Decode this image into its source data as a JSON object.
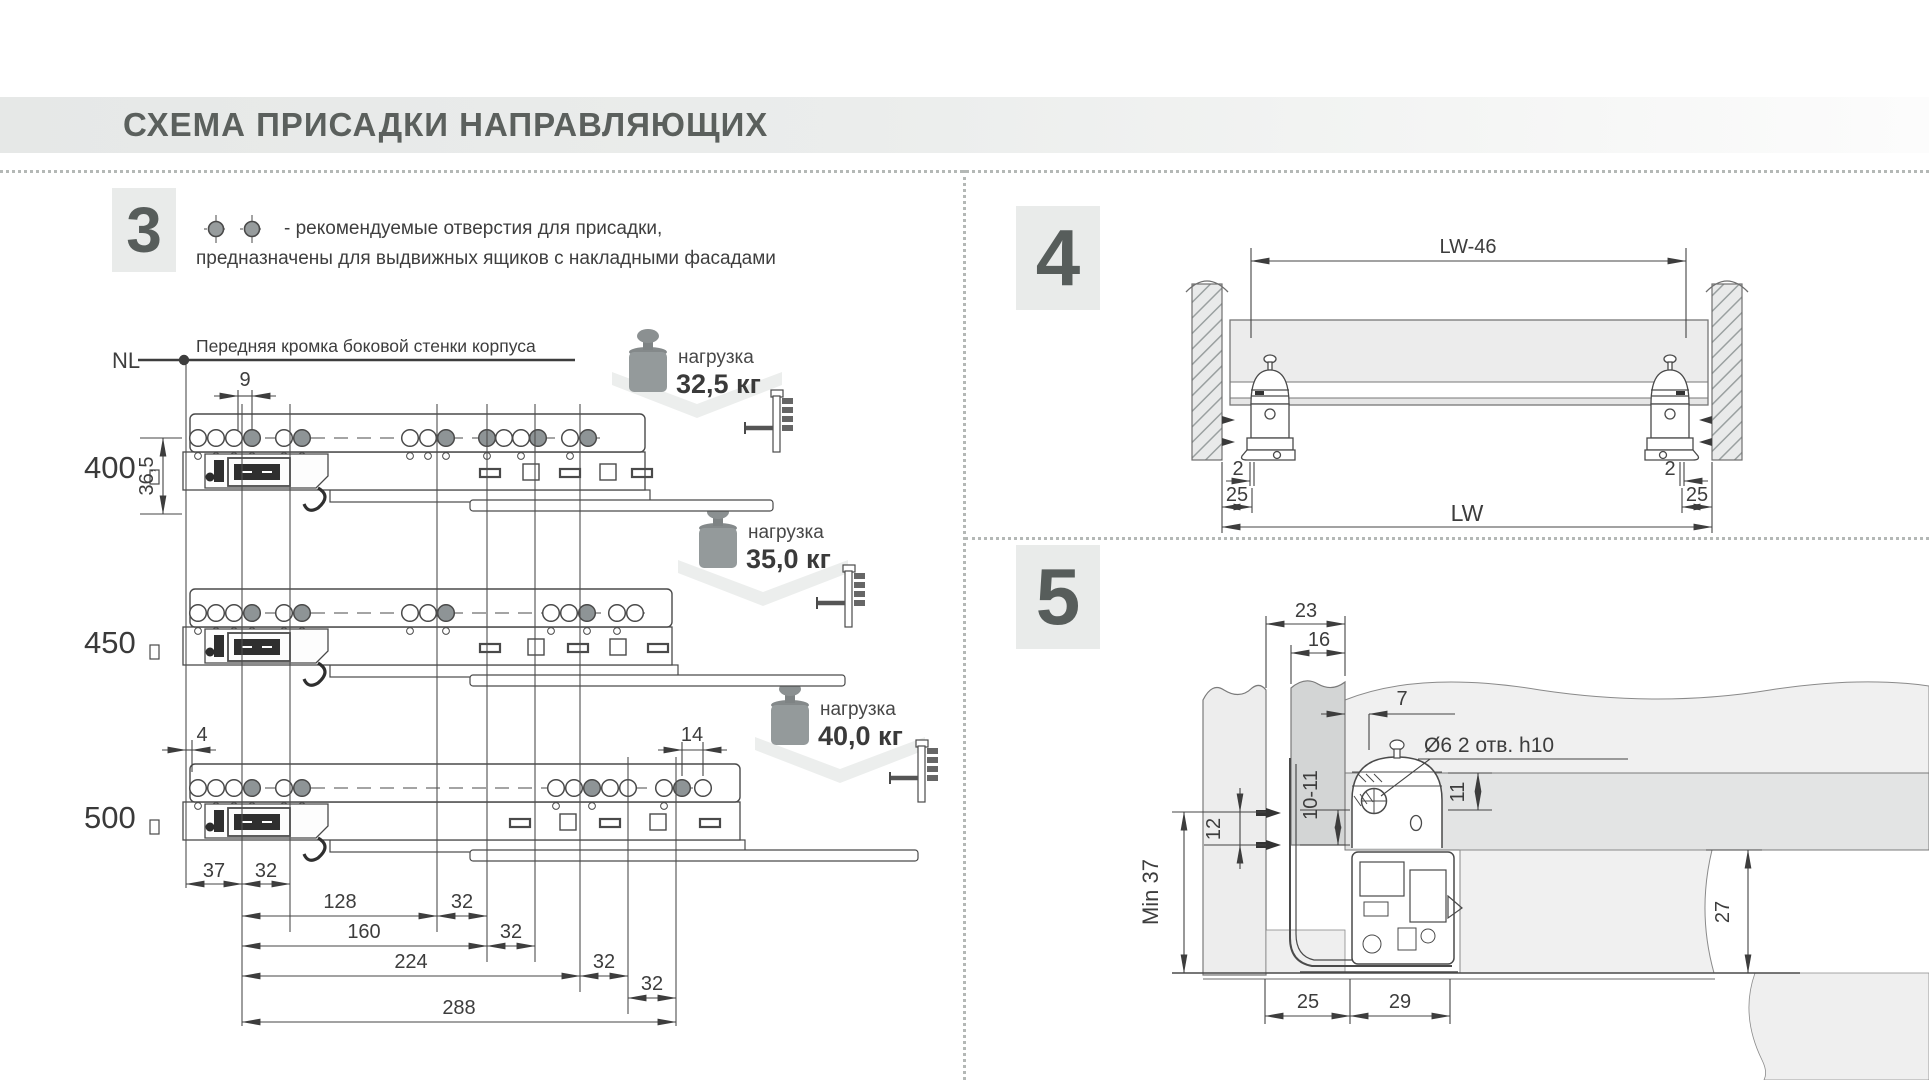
{
  "title": "СХЕМА ПРИСАДКИ НАПРАВЛЯЮЩИХ",
  "colors": {
    "band_gray": "#e8eae9",
    "box_gray": "#e9ebea",
    "number_gray": "#575d5b",
    "line": "#474747",
    "panel_light": "#efefef",
    "panel_mid": "#e3e4e4",
    "panel_dark": "#d3d5d5"
  },
  "section3": {
    "number": "3",
    "legend": {
      "line1": "-  рекомендуемые отверстия для присадки,",
      "line2": "предназначены для выдвижных ящиков с накладными фасадами"
    },
    "nl_label": "NL",
    "front_edge_note": "Передняя кромка боковой стенки корпуса",
    "rows": [
      {
        "length": "400",
        "load_label": "нагрузка",
        "load_value": "32,5 кг"
      },
      {
        "length": "450",
        "load_label": "нагрузка",
        "load_value": "35,0 кг"
      },
      {
        "length": "500",
        "load_label": "нагрузка",
        "load_value": "40,0 кг"
      }
    ],
    "dims": {
      "d9": "9",
      "d36_5": "36,5",
      "d4": "4",
      "d14": "14",
      "d37": "37",
      "d32": "32",
      "d128": "128",
      "d160": "160",
      "d224": "224",
      "d288": "288"
    }
  },
  "section4": {
    "number": "4",
    "dims": {
      "lw46": "LW-46",
      "d2": "2",
      "d25": "25",
      "lw": "LW"
    }
  },
  "section5": {
    "number": "5",
    "dims": {
      "d23": "23",
      "d16": "16",
      "d7": "7",
      "hole_note": "Ø6  2 отв. h10",
      "d10_11": "10-11",
      "d12": "12",
      "d11": "11",
      "min37": "Min 37",
      "d27": "27",
      "d25": "25",
      "d29": "29"
    }
  }
}
